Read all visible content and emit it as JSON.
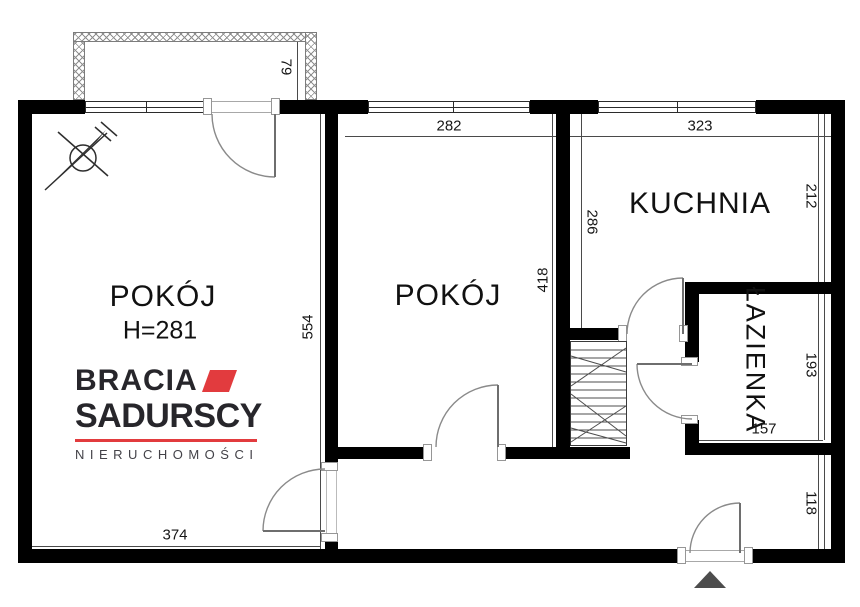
{
  "floor_plan": {
    "rooms": [
      {
        "id": "room-left",
        "label": "POKÓJ",
        "note": "H=281"
      },
      {
        "id": "room-middle",
        "label": "POKÓJ"
      },
      {
        "id": "kitchen",
        "label": "KUCHNIA"
      },
      {
        "id": "bathroom",
        "label": "ŁAZIENKA"
      }
    ],
    "dimensions": {
      "balcony_depth": "79",
      "room_middle_width": "282",
      "kitchen_width": "323",
      "kitchen_left_height": "286",
      "room_middle_height": "418",
      "kitchen_right_height": "212",
      "bathroom_height": "193",
      "bathroom_width": "157",
      "hall_height": "118",
      "room_left_height": "554",
      "room_left_width": "374"
    }
  },
  "logo": {
    "brand_line1": "BRACIA",
    "brand_line2": "SADURSCY",
    "tagline": "NIERUCHOMOŚCI"
  },
  "colors": {
    "wall": "#000000",
    "brand_red": "#e23b3e",
    "logo_text": "#27262b",
    "entrance_marker": "#4d4d4d"
  }
}
